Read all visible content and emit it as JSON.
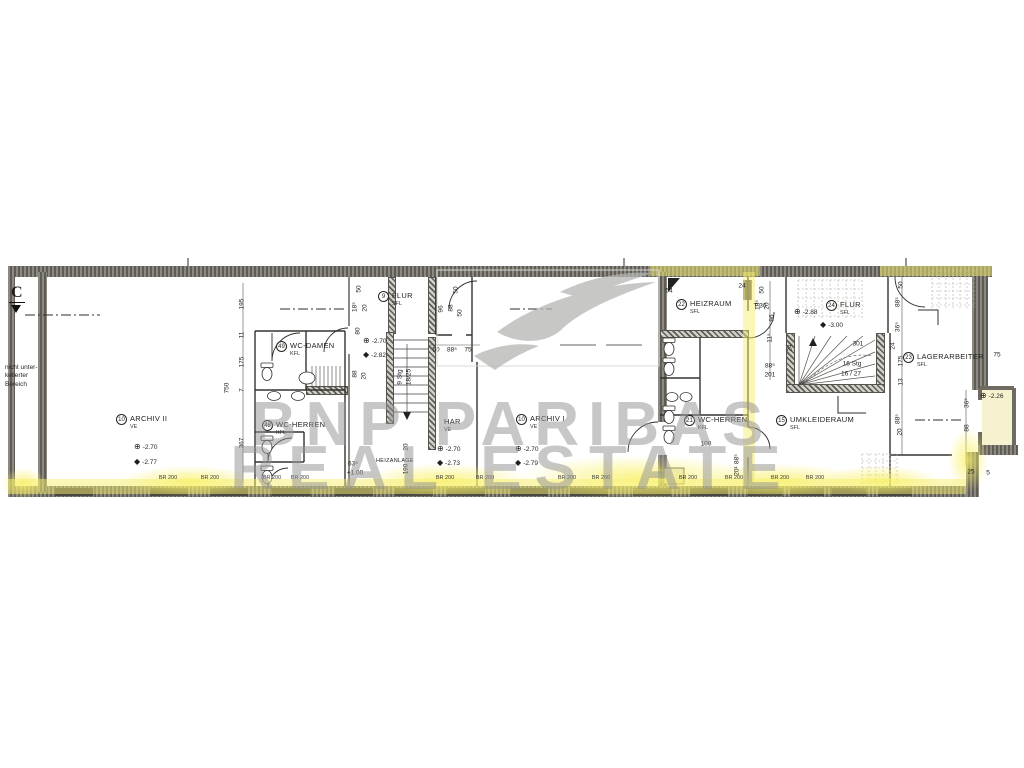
{
  "watermark": {
    "line1": "BNP PARIBAS",
    "line2": "REAL ESTATE"
  },
  "section": {
    "label": "C"
  },
  "note": [
    "nicht unter-",
    "kellerter",
    "Bereich"
  ],
  "door_label": "T 30",
  "stairs": {
    "mid_a": "9 Stg",
    "mid_b": "18/25",
    "right_count": "16 Stg",
    "right_ratio": "16 / 27",
    "right_num": "301"
  },
  "rooms": [
    {
      "num": "10",
      "name": "ARCHIV II",
      "sub": "VE",
      "x": 116,
      "y": 414
    },
    {
      "num": "49",
      "name": "WC-DAMEN",
      "sub": "KFL",
      "x": 276,
      "y": 341
    },
    {
      "num": "48",
      "name": "WC-HERREN",
      "sub": "KFL",
      "x": 262,
      "y": 420
    },
    {
      "num": "9",
      "name": "FLUR",
      "sub": "SFL",
      "x": 378,
      "y": 291
    },
    {
      "num": "",
      "name": "HAR",
      "sub": "VE",
      "x": 444,
      "y": 417
    },
    {
      "num": "10",
      "name": "ARCHIV I",
      "sub": "VE",
      "x": 516,
      "y": 414
    },
    {
      "num": "22",
      "name": "HEIZRAUM",
      "sub": "SFL",
      "x": 676,
      "y": 299
    },
    {
      "num": "24",
      "name": "FLUR",
      "sub": "SFL",
      "x": 826,
      "y": 300
    },
    {
      "num": "23",
      "name": "LAGERARBEITER",
      "sub": "SFL",
      "x": 903,
      "y": 352
    },
    {
      "num": "21",
      "name": "WC-HERREN",
      "sub": "KFL",
      "x": 684,
      "y": 415
    },
    {
      "num": "15",
      "name": "UMKLEIDERAUM",
      "sub": "SFL",
      "x": 776,
      "y": 415
    },
    {
      "num": "",
      "name": "HEIZANLAGE",
      "sub": "",
      "x": 376,
      "y": 458,
      "small": true
    }
  ],
  "levels": [
    {
      "s": "⊕",
      "v": "-2.70",
      "x": 134,
      "y": 443
    },
    {
      "s": "◆",
      "v": "-2.77",
      "x": 134,
      "y": 458
    },
    {
      "s": "⊕",
      "v": "-2.70",
      "x": 363,
      "y": 337
    },
    {
      "s": "◆",
      "v": "-2.82",
      "x": 363,
      "y": 351
    },
    {
      "s": "⊕",
      "v": "-2.70",
      "x": 437,
      "y": 445
    },
    {
      "s": "◆",
      "v": "-2.73",
      "x": 437,
      "y": 459
    },
    {
      "s": "⊕",
      "v": "-2.70",
      "x": 515,
      "y": 445
    },
    {
      "s": "◆",
      "v": "-2.79",
      "x": 515,
      "y": 459
    },
    {
      "s": "⊕",
      "v": "-2.88",
      "x": 794,
      "y": 308
    },
    {
      "s": "◆",
      "v": "-3.00",
      "x": 820,
      "y": 321
    },
    {
      "s": "⊕",
      "v": "-2.26",
      "x": 980,
      "y": 392
    }
  ],
  "dims": [
    {
      "t": "750",
      "x": 227,
      "y": 388,
      "r": 1
    },
    {
      "t": "195",
      "x": 242,
      "y": 304,
      "r": 1
    },
    {
      "t": "11",
      "x": 242,
      "y": 335,
      "r": 1
    },
    {
      "t": "175",
      "x": 242,
      "y": 362,
      "r": 1
    },
    {
      "t": "7",
      "x": 242,
      "y": 390,
      "r": 1
    },
    {
      "t": "367",
      "x": 242,
      "y": 443,
      "r": 1
    },
    {
      "t": "50",
      "x": 359,
      "y": 289,
      "r": 1
    },
    {
      "t": "18⁵",
      "x": 355,
      "y": 307,
      "r": 1
    },
    {
      "t": "20",
      "x": 365,
      "y": 308,
      "r": 1
    },
    {
      "t": "80",
      "x": 358,
      "y": 331,
      "r": 1
    },
    {
      "t": "88",
      "x": 355,
      "y": 374,
      "r": 1
    },
    {
      "t": "20",
      "x": 364,
      "y": 376,
      "r": 1
    },
    {
      "t": "96",
      "x": 441,
      "y": 309,
      "r": 1
    },
    {
      "t": "50",
      "x": 456,
      "y": 290,
      "r": 1
    },
    {
      "t": "88",
      "x": 451,
      "y": 308,
      "r": 1
    },
    {
      "t": "50",
      "x": 460,
      "y": 313,
      "r": 1
    },
    {
      "t": "50",
      "x": 436,
      "y": 350,
      "r": 0
    },
    {
      "t": "88⁵",
      "x": 452,
      "y": 350,
      "r": 0
    },
    {
      "t": "75",
      "x": 468,
      "y": 350,
      "r": 0
    },
    {
      "t": "63⁵",
      "x": 353,
      "y": 464,
      "r": 0
    },
    {
      "t": "+1.00",
      "x": 355,
      "y": 473,
      "r": 0
    },
    {
      "t": "190",
      "x": 406,
      "y": 469,
      "r": 1
    },
    {
      "t": "20",
      "x": 406,
      "y": 447,
      "r": 1
    },
    {
      "t": "54",
      "x": 669,
      "y": 291,
      "r": 0
    },
    {
      "t": "24",
      "x": 742,
      "y": 286,
      "r": 0
    },
    {
      "t": "50",
      "x": 762,
      "y": 290,
      "r": 1
    },
    {
      "t": "18⁵",
      "x": 758,
      "y": 305,
      "r": 1
    },
    {
      "t": "20",
      "x": 767,
      "y": 306,
      "r": 1
    },
    {
      "t": "96",
      "x": 772,
      "y": 318,
      "r": 1
    },
    {
      "t": "11⁵",
      "x": 770,
      "y": 338,
      "r": 1
    },
    {
      "t": "88⁵",
      "x": 770,
      "y": 366,
      "r": 0
    },
    {
      "t": "201",
      "x": 770,
      "y": 375,
      "r": 0
    },
    {
      "t": "24",
      "x": 790,
      "y": 348,
      "r": 1
    },
    {
      "t": "24",
      "x": 893,
      "y": 346,
      "r": 1
    },
    {
      "t": "50",
      "x": 901,
      "y": 285,
      "r": 1
    },
    {
      "t": "88⁵",
      "x": 898,
      "y": 302,
      "r": 1
    },
    {
      "t": "36⁵",
      "x": 898,
      "y": 327,
      "r": 1
    },
    {
      "t": "175",
      "x": 901,
      "y": 361,
      "r": 1
    },
    {
      "t": "13",
      "x": 901,
      "y": 382,
      "r": 1
    },
    {
      "t": "88⁵",
      "x": 898,
      "y": 419,
      "r": 1
    },
    {
      "t": "20",
      "x": 900,
      "y": 432,
      "r": 1
    },
    {
      "t": "75",
      "x": 997,
      "y": 355,
      "r": 0
    },
    {
      "t": "36⁵",
      "x": 967,
      "y": 403,
      "r": 1
    },
    {
      "t": "88",
      "x": 967,
      "y": 428,
      "r": 1
    },
    {
      "t": "25",
      "x": 971,
      "y": 472,
      "r": 0
    },
    {
      "t": "5",
      "x": 988,
      "y": 473,
      "r": 0
    },
    {
      "t": "100",
      "x": 706,
      "y": 444,
      "r": 0
    },
    {
      "t": "88⁵",
      "x": 737,
      "y": 459,
      "r": 1
    },
    {
      "t": "20¹",
      "x": 737,
      "y": 471,
      "r": 1
    }
  ],
  "bottom": {
    "label": "BR 200",
    "y": 478,
    "xs": [
      168,
      210,
      272,
      300,
      445,
      485,
      567,
      601,
      688,
      734,
      780,
      815
    ]
  }
}
